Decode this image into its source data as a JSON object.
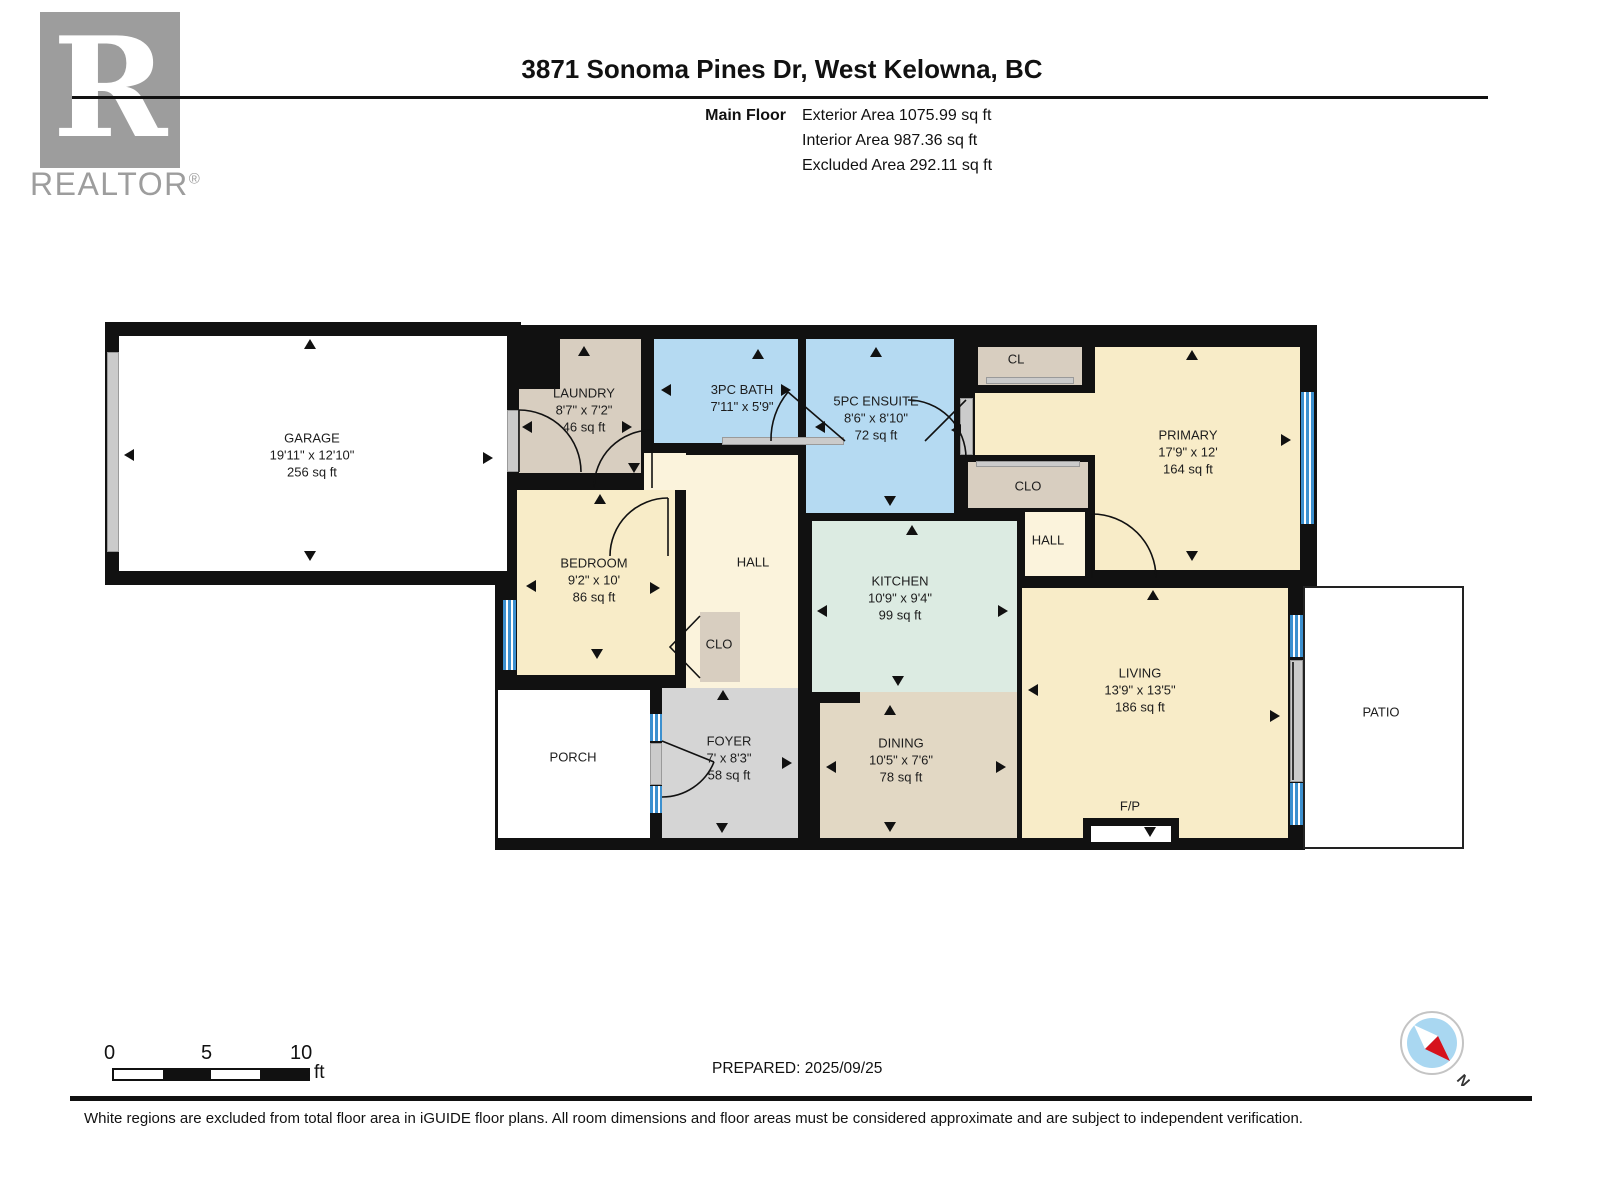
{
  "header": {
    "title": "3871 Sonoma Pines Dr, West Kelowna, BC",
    "floor_label": "Main Floor",
    "areas": [
      "Exterior Area 1075.99 sq ft",
      "Interior Area 987.36 sq ft",
      "Excluded Area 292.11 sq ft"
    ]
  },
  "logo": {
    "letter": "R",
    "brand": "REALTOR",
    "reg": "®"
  },
  "scale": {
    "ticks": [
      "0",
      "5",
      "10"
    ],
    "unit": "ft"
  },
  "compass": {
    "north": "N"
  },
  "footer": {
    "prepared": "PREPARED: 2025/09/25",
    "disclaimer": "White regions are excluded from total floor area in iGUIDE floor plans. All room dimensions and floor areas must be considered approximate and are subject to independent verification."
  },
  "plan": {
    "colors": {
      "wall": "#111111",
      "white": "#ffffff",
      "cream": "#f8ecc8",
      "cream2": "#fbf3dc",
      "tan": "#d8cec0",
      "tanD": "#e2d8c4",
      "blue": "#b5daf2",
      "mint": "#dcebe2",
      "grayF": "#d5d5d5",
      "door_gray": "#cbcbcb",
      "window_stripe": "#3c90cf",
      "compass_blue": "#a9d7f1",
      "compass_red": "#d6121c"
    },
    "walls": [
      [
        105,
        322,
        416,
        263
      ],
      [
        495,
        325,
        822,
        250
      ],
      [
        495,
        575,
        810,
        275
      ],
      [
        1300,
        570,
        17,
        18
      ]
    ],
    "patio": [
      1303,
      586,
      157,
      259
    ],
    "paints": [
      [
        "garage",
        119,
        336,
        388,
        235,
        "white"
      ],
      [
        "laundry",
        519,
        339,
        122,
        134,
        "tan"
      ],
      [
        "laundry-notch",
        519,
        339,
        41,
        50,
        "wall"
      ],
      [
        "landing",
        644,
        453,
        42,
        37,
        "cream2"
      ],
      [
        "hall-main",
        686,
        455,
        112,
        233,
        "cream2"
      ],
      [
        "bath-3pc",
        654,
        339,
        144,
        104,
        "blue"
      ],
      [
        "ensuite-5pc",
        806,
        339,
        148,
        174,
        "blue"
      ],
      [
        "primary-vestibule",
        975,
        393,
        122,
        62,
        "cream"
      ],
      [
        "closet-cl",
        978,
        347,
        104,
        38,
        "tan"
      ],
      [
        "primary",
        1095,
        347,
        205,
        223,
        "cream"
      ],
      [
        "closet-primary",
        968,
        462,
        120,
        46,
        "tan"
      ],
      [
        "hall-primary",
        1025,
        512,
        60,
        64,
        "cream2"
      ],
      [
        "bedroom",
        517,
        490,
        158,
        185,
        "cream"
      ],
      [
        "closet-bedroom",
        700,
        612,
        40,
        70,
        "tan"
      ],
      [
        "kitchen",
        812,
        521,
        205,
        171,
        "mint"
      ],
      [
        "dining",
        820,
        703,
        197,
        135,
        "tanD"
      ],
      [
        "dining-opening",
        860,
        692,
        157,
        11,
        "tanD"
      ],
      [
        "living",
        1022,
        588,
        266,
        250,
        "cream"
      ],
      [
        "foyer",
        662,
        688,
        136,
        150,
        "grayF"
      ],
      [
        "porch",
        498,
        690,
        152,
        148,
        "white"
      ]
    ],
    "fireplace": {
      "outer": [
        1083,
        818,
        96,
        30
      ],
      "inner": [
        1091,
        826,
        80,
        16
      ]
    },
    "thresholds": [
      [
        107,
        352,
        12,
        200
      ],
      [
        507,
        410,
        12,
        62
      ],
      [
        722,
        437,
        122,
        8
      ],
      [
        960,
        398,
        13,
        57
      ],
      [
        986,
        377,
        88,
        7
      ],
      [
        976,
        461,
        104,
        6
      ],
      [
        1290,
        660,
        13,
        122
      ],
      [
        650,
        743,
        12,
        42
      ]
    ],
    "windows": [
      [
        503,
        600,
        13,
        70
      ],
      [
        1301,
        392,
        13,
        132
      ],
      [
        1290,
        615,
        13,
        42
      ],
      [
        1290,
        783,
        13,
        42
      ],
      [
        650,
        714,
        12,
        27
      ],
      [
        650,
        786,
        12,
        27
      ]
    ],
    "doors": [
      "M519,472 L519,410",
      "M519,410 A62,62 0 0 1 581,472",
      "M652,488 L652,430",
      "M652,430 A58,58 0 0 0 594,488",
      "M668,556 L668,498",
      "M668,498 A58,58 0 0 0 610,556",
      "M845,441 L788,392",
      "M771,441 A74,74 0 0 1 788,392",
      "M966,400 L925,441",
      "M908,400 A58,58 0 0 1 966,458",
      "M1092,578 L1092,514",
      "M1092,514 A64,64 0 0 1 1156,578",
      "M662,741 L714,762",
      "M714,762 A56,56 0 0 1 662,797",
      "M700,616 L670,647 L700,678",
      "M1293,662 L1293,780"
    ],
    "arrows": [
      [
        310,
        344,
        "u"
      ],
      [
        310,
        556,
        "d"
      ],
      [
        129,
        455,
        "l"
      ],
      [
        488,
        458,
        "r"
      ],
      [
        584,
        351,
        "u"
      ],
      [
        527,
        427,
        "l"
      ],
      [
        627,
        427,
        "r"
      ],
      [
        634,
        468,
        "d"
      ],
      [
        758,
        354,
        "u"
      ],
      [
        666,
        390,
        "l"
      ],
      [
        786,
        390,
        "r"
      ],
      [
        876,
        352,
        "u"
      ],
      [
        820,
        427,
        "l"
      ],
      [
        890,
        501,
        "d"
      ],
      [
        956,
        430,
        "l"
      ],
      [
        1192,
        355,
        "u"
      ],
      [
        1286,
        440,
        "r"
      ],
      [
        1192,
        556,
        "d"
      ],
      [
        600,
        499,
        "u"
      ],
      [
        531,
        586,
        "l"
      ],
      [
        655,
        588,
        "r"
      ],
      [
        597,
        654,
        "d"
      ],
      [
        912,
        530,
        "u"
      ],
      [
        822,
        611,
        "l"
      ],
      [
        1003,
        611,
        "r"
      ],
      [
        898,
        681,
        "d"
      ],
      [
        890,
        710,
        "u"
      ],
      [
        831,
        767,
        "l"
      ],
      [
        1001,
        767,
        "r"
      ],
      [
        890,
        827,
        "d"
      ],
      [
        1153,
        595,
        "u"
      ],
      [
        1033,
        690,
        "l"
      ],
      [
        1275,
        716,
        "r"
      ],
      [
        1150,
        832,
        "d"
      ],
      [
        723,
        695,
        "u"
      ],
      [
        787,
        763,
        "r"
      ],
      [
        722,
        828,
        "d"
      ]
    ],
    "room_labels": [
      {
        "x": 312,
        "y": 455,
        "lines": [
          "GARAGE",
          "19'11\" x 12'10\"",
          "256 sq ft"
        ]
      },
      {
        "x": 584,
        "y": 410,
        "lines": [
          "LAUNDRY",
          "8'7\" x 7'2\"",
          "46 sq ft"
        ]
      },
      {
        "x": 742,
        "y": 398,
        "lines": [
          "3PC BATH",
          "7'11\" x 5'9\""
        ]
      },
      {
        "x": 876,
        "y": 418,
        "lines": [
          "5PC ENSUITE",
          "8'6\" x 8'10\"",
          "72 sq ft"
        ]
      },
      {
        "x": 1188,
        "y": 452,
        "lines": [
          "PRIMARY",
          "17'9\" x 12'",
          "164 sq ft"
        ]
      },
      {
        "x": 594,
        "y": 580,
        "lines": [
          "BEDROOM",
          "9'2\" x 10'",
          "86 sq ft"
        ]
      },
      {
        "x": 900,
        "y": 598,
        "lines": [
          "KITCHEN",
          "10'9\" x 9'4\"",
          "99 sq ft"
        ]
      },
      {
        "x": 1140,
        "y": 690,
        "lines": [
          "LIVING",
          "13'9\" x 13'5\"",
          "186 sq ft"
        ]
      },
      {
        "x": 901,
        "y": 760,
        "lines": [
          "DINING",
          "10'5\" x 7'6\"",
          "78 sq ft"
        ]
      },
      {
        "x": 729,
        "y": 758,
        "lines": [
          "FOYER",
          "7' x 8'3\"",
          "58 sq ft"
        ]
      },
      {
        "x": 1016,
        "y": 359,
        "lines": [
          "CL"
        ]
      },
      {
        "x": 1028,
        "y": 486,
        "lines": [
          "CLO"
        ]
      },
      {
        "x": 1048,
        "y": 540,
        "lines": [
          "HALL"
        ]
      },
      {
        "x": 753,
        "y": 562,
        "lines": [
          "HALL"
        ]
      },
      {
        "x": 719,
        "y": 644,
        "lines": [
          "CLO"
        ]
      },
      {
        "x": 573,
        "y": 757,
        "lines": [
          "PORCH"
        ]
      },
      {
        "x": 1381,
        "y": 712,
        "lines": [
          "PATIO"
        ]
      },
      {
        "x": 1130,
        "y": 806,
        "lines": [
          "F/P"
        ]
      }
    ]
  }
}
